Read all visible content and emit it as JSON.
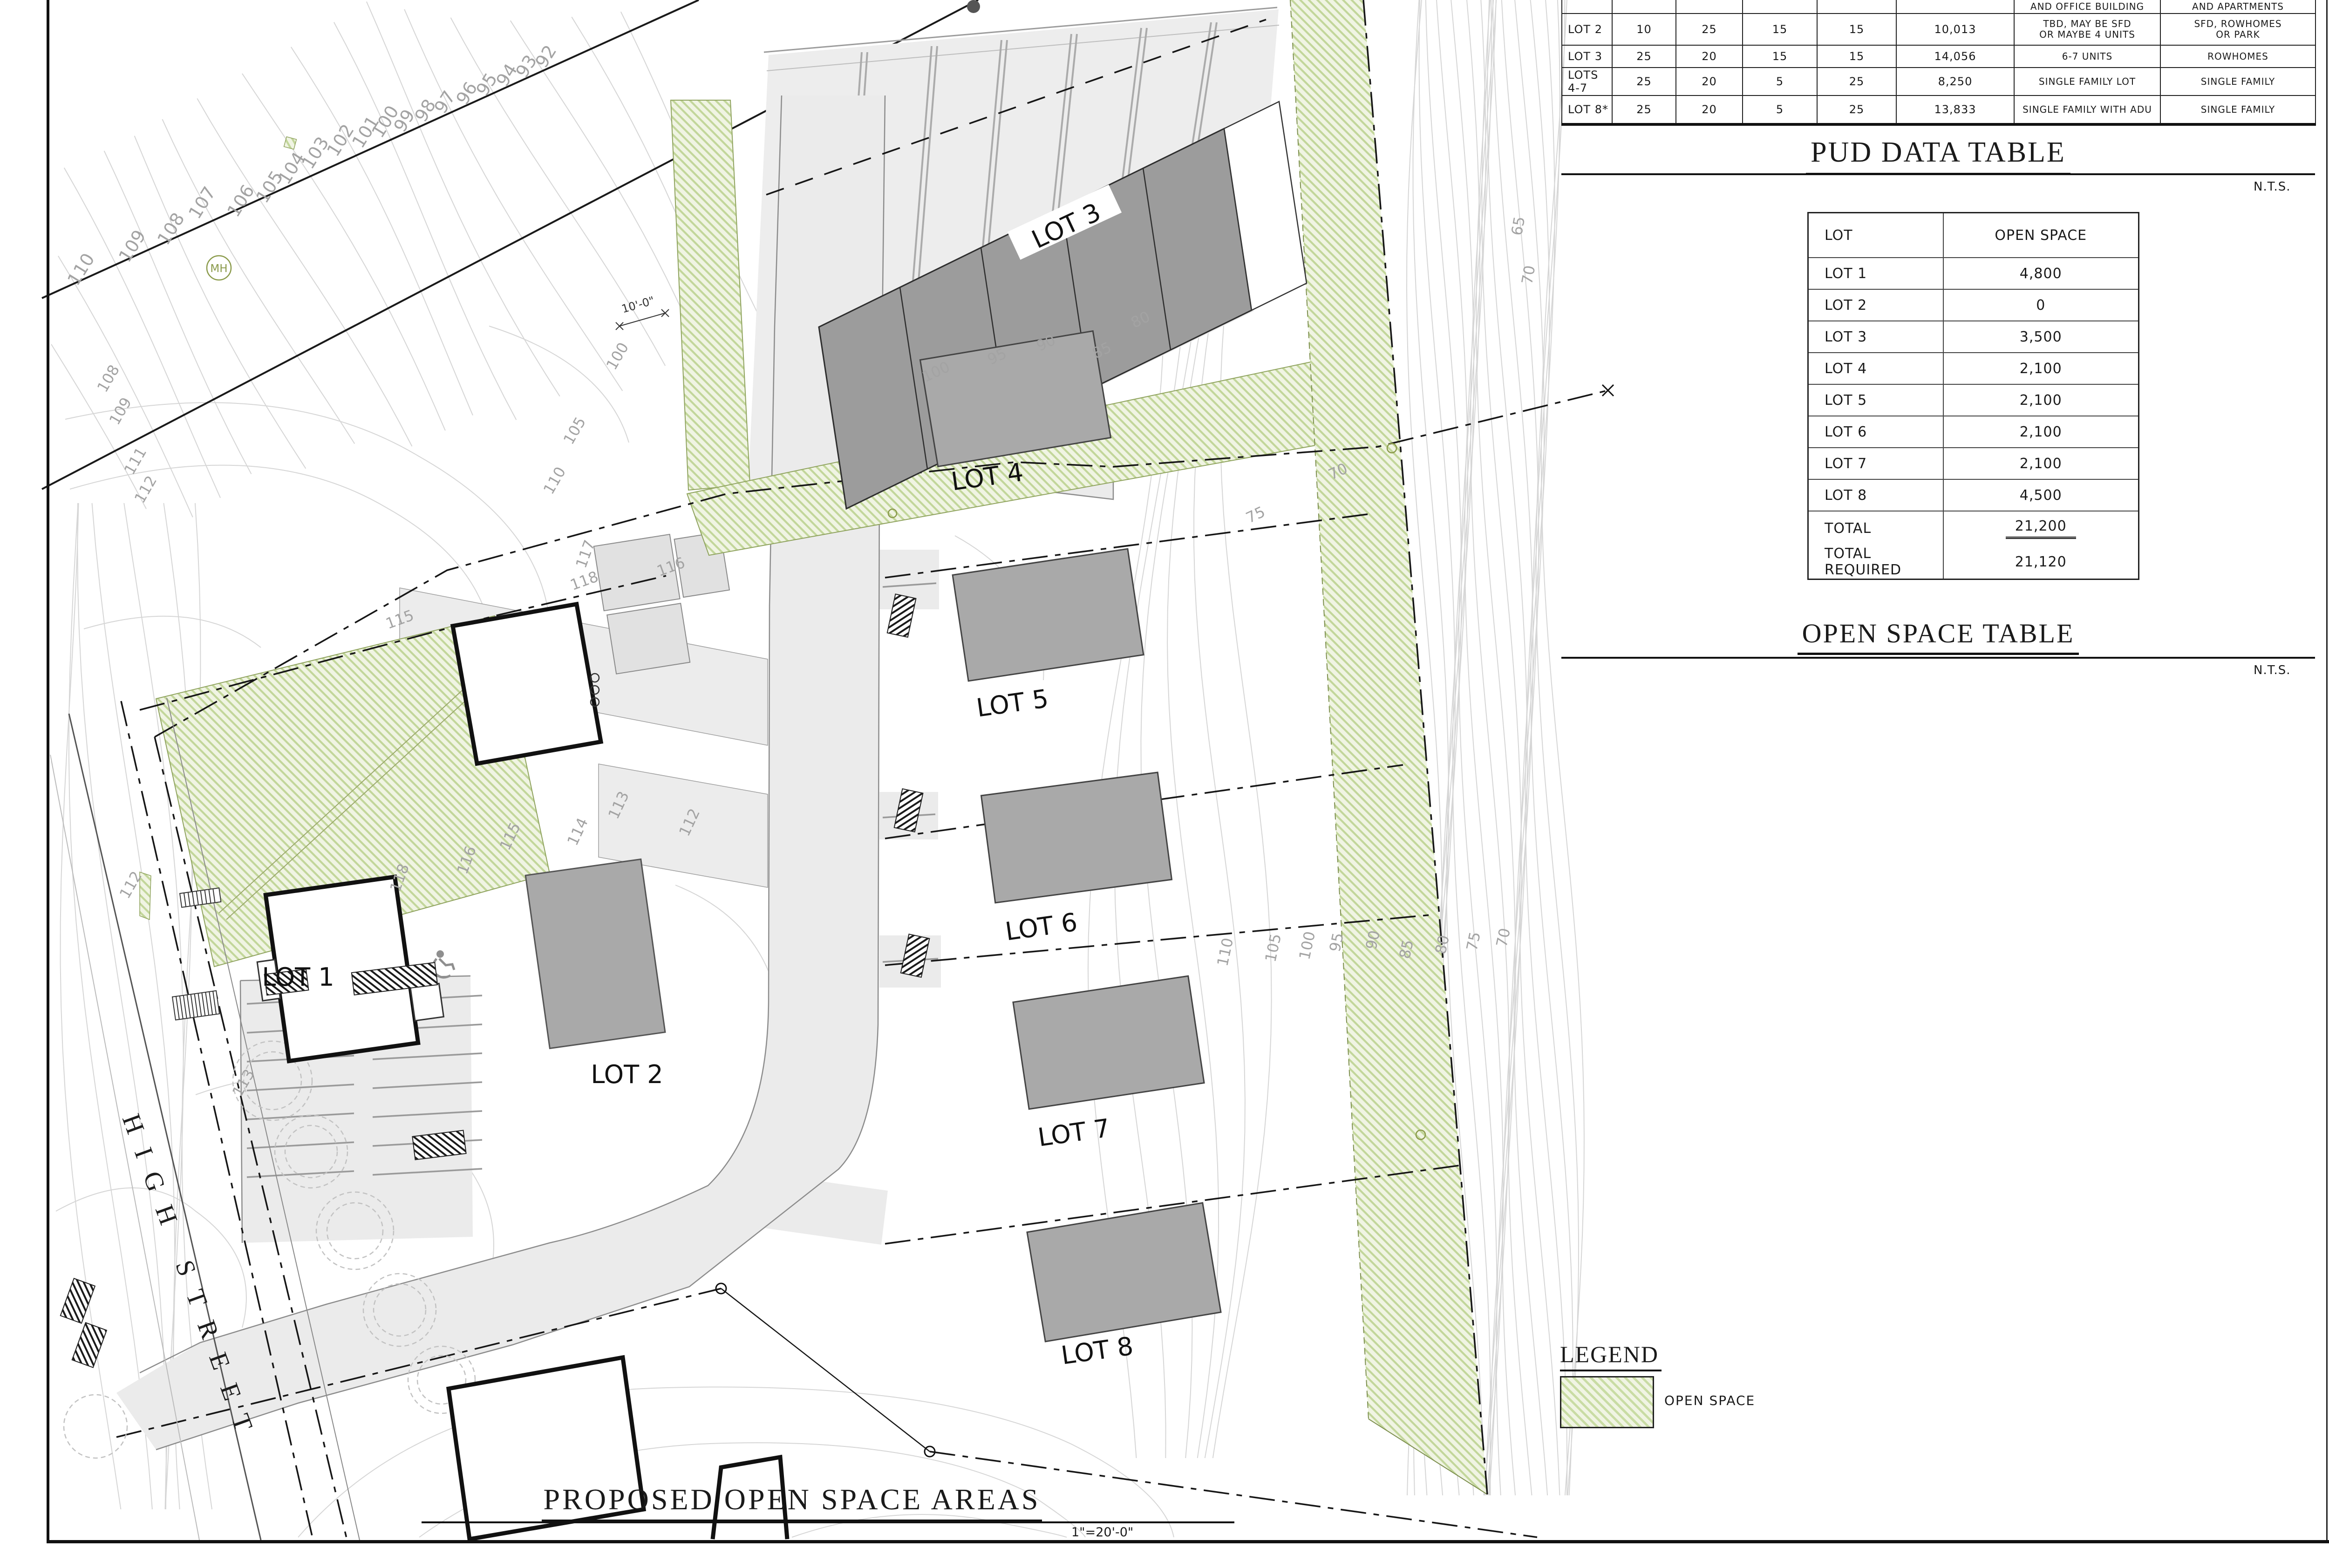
{
  "titles": {
    "plan_title": "PROPOSED OPEN SPACE AREAS",
    "plan_scale": "1\"=20'-0\"",
    "pud": "PUD DATA TABLE",
    "open_space": "OPEN SPACE TABLE",
    "nts": "N.T.S."
  },
  "pud_table": {
    "partial_row": {
      "c7": "AND OFFICE BUILDING",
      "c8": "AND APARTMENTS"
    },
    "rows": [
      {
        "c1": "LOT 2",
        "c2": "10",
        "c3": "25",
        "c4": "15",
        "c5": "15",
        "c6": "10,013",
        "c7": "TBD, MAY BE SFD\nOR MAYBE 4 UNITS",
        "c8": "SFD, ROWHOMES\nOR PARK"
      },
      {
        "c1": "LOT 3",
        "c2": "25",
        "c3": "20",
        "c4": "15",
        "c5": "15",
        "c6": "14,056",
        "c7": "6-7 UNITS",
        "c8": "ROWHOMES"
      },
      {
        "c1": "LOTS 4-7",
        "c2": "25",
        "c3": "20",
        "c4": "5",
        "c5": "25",
        "c6": "8,250",
        "c7": "SINGLE FAMILY LOT",
        "c8": "SINGLE FAMILY"
      },
      {
        "c1": "LOT 8*",
        "c2": "25",
        "c3": "20",
        "c4": "5",
        "c5": "25",
        "c6": "13,833",
        "c7": "SINGLE FAMILY WITH ADU",
        "c8": "SINGLE FAMILY"
      }
    ]
  },
  "open_space_table": {
    "headers": [
      "LOT",
      "OPEN SPACE"
    ],
    "rows": [
      [
        "LOT 1",
        "4,800"
      ],
      [
        "LOT 2",
        "0"
      ],
      [
        "LOT 3",
        "3,500"
      ],
      [
        "LOT 4",
        "2,100"
      ],
      [
        "LOT 5",
        "2,100"
      ],
      [
        "LOT 6",
        "2,100"
      ],
      [
        "LOT 7",
        "2,100"
      ],
      [
        "LOT 8",
        "4,500"
      ],
      [
        "TOTAL",
        "21,200"
      ],
      [
        "TOTAL REQUIRED",
        "21,120"
      ]
    ]
  },
  "legend": {
    "title": "LEGEND",
    "open_space": "OPEN SPACE"
  },
  "titleblock": {
    "owner_company": "BIG BRIDGE VENTURES, LLC",
    "owner_name": "CARL SAVITZ",
    "owner_phone": "303-819-3086",
    "owner_label": "OWNER",
    "project_name": "HIGHVIEW SUBDIVISION",
    "project_street": "243 HIGH STREET",
    "project_city": "BELFAST, MAINE 04915",
    "project_label": "PROJECT ADDRESS",
    "scale_label": "SCALE:",
    "scale_value": "1\"=20'-0\"",
    "drawn_label": "DRAWN:",
    "drawn_value": "KK",
    "date_label": "DATE:",
    "date_value": "4/17/2025",
    "issue_label": "ISSUE:",
    "issue_value": "",
    "sheet_number": "A1"
  },
  "plan": {
    "street_name": "HIGH STREET",
    "mh": "MH",
    "dim_label": "10'-0\"",
    "lots": [
      "LOT 1",
      "LOT 2",
      "LOT 3",
      "LOT 4",
      "LOT 5",
      "LOT 6",
      "LOT 7",
      "LOT 8"
    ],
    "colors": {
      "open_space_fill": "#f0f4e3",
      "open_space_hatch": "#c2d69a",
      "road_fill": "#ebebeb",
      "building_fill": "#a9a9a9",
      "contour": "#d6d6d6"
    },
    "contour_labels": [
      "110",
      "109",
      "108",
      "107",
      "106",
      "105",
      "104",
      "103",
      "102",
      "101",
      "100",
      "99",
      "98",
      "97",
      "96",
      "95",
      "94",
      "93",
      "92",
      "108",
      "109",
      "111",
      "112",
      "112",
      "113",
      "105",
      "110",
      "100",
      "115",
      "116",
      "118",
      "117",
      "118",
      "116",
      "113",
      "114",
      "115",
      "112",
      "100",
      "95",
      "90",
      "85",
      "80",
      "75",
      "70",
      "110",
      "105",
      "100",
      "95",
      "90",
      "85",
      "80",
      "75",
      "70",
      "65",
      "70"
    ]
  }
}
